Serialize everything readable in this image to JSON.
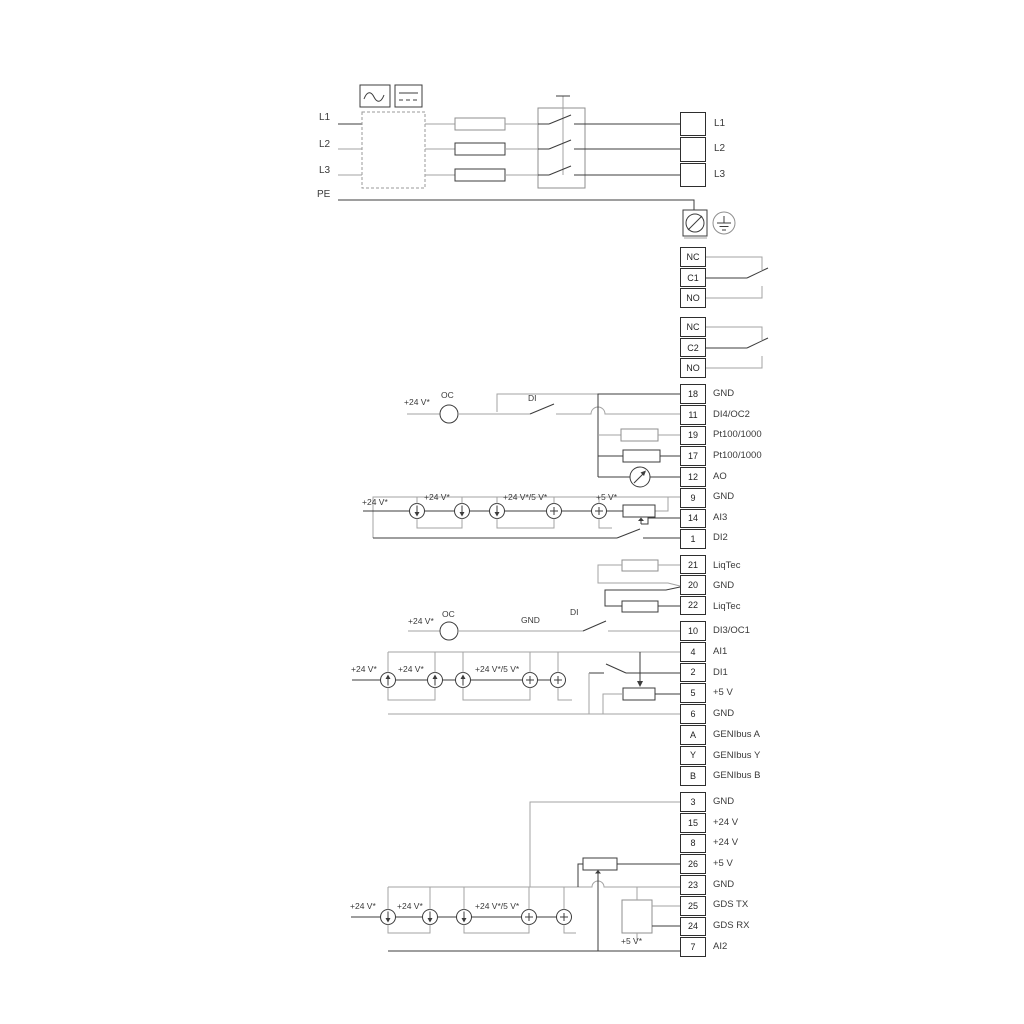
{
  "power": {
    "inputs": [
      "L1",
      "L2",
      "L3",
      "PE"
    ],
    "outputs": [
      "L1",
      "L2",
      "L3"
    ]
  },
  "relays": {
    "r1": {
      "rows": [
        "NC",
        "C1",
        "NO"
      ]
    },
    "r2": {
      "rows": [
        "NC",
        "C2",
        "NO"
      ]
    }
  },
  "strips": {
    "io1": {
      "rows": [
        {
          "num": "18",
          "label": "GND"
        },
        {
          "num": "11",
          "label": "DI4/OC2"
        },
        {
          "num": "19",
          "label": "Pt100/1000"
        },
        {
          "num": "17",
          "label": "Pt100/1000"
        },
        {
          "num": "12",
          "label": "AO"
        },
        {
          "num": "9",
          "label": "GND"
        },
        {
          "num": "14",
          "label": "AI3"
        },
        {
          "num": "1",
          "label": "DI2"
        }
      ]
    },
    "liqtec": {
      "rows": [
        {
          "num": "21",
          "label": "LiqTec"
        },
        {
          "num": "20",
          "label": "GND"
        },
        {
          "num": "22",
          "label": "LiqTec"
        }
      ]
    },
    "io2": {
      "rows": [
        {
          "num": "10",
          "label": "DI3/OC1"
        },
        {
          "num": "4",
          "label": "AI1"
        },
        {
          "num": "2",
          "label": "DI1"
        },
        {
          "num": "5",
          "label": "+5 V"
        },
        {
          "num": "6",
          "label": "GND"
        },
        {
          "num": "A",
          "label": "GENIbus A"
        },
        {
          "num": "Y",
          "label": "GENIbus Y"
        },
        {
          "num": "B",
          "label": "GENIbus B"
        }
      ]
    },
    "io3": {
      "rows": [
        {
          "num": "3",
          "label": "GND"
        },
        {
          "num": "15",
          "label": "+24 V"
        },
        {
          "num": "8",
          "label": "+24 V"
        },
        {
          "num": "26",
          "label": "+5 V"
        },
        {
          "num": "23",
          "label": "GND"
        },
        {
          "num": "25",
          "label": "GDS TX"
        },
        {
          "num": "24",
          "label": "GDS RX"
        },
        {
          "num": "7",
          "label": "AI2"
        }
      ]
    }
  },
  "annotations": {
    "v24": "+24 V*",
    "v24or5": "+24 V*/5 V*",
    "v5": "+5 V*",
    "oc": "OC",
    "di": "DI",
    "gnd": "GND"
  },
  "colors": {
    "line_dark": "#3c3c3c",
    "line_grey": "#a3a3a3"
  }
}
